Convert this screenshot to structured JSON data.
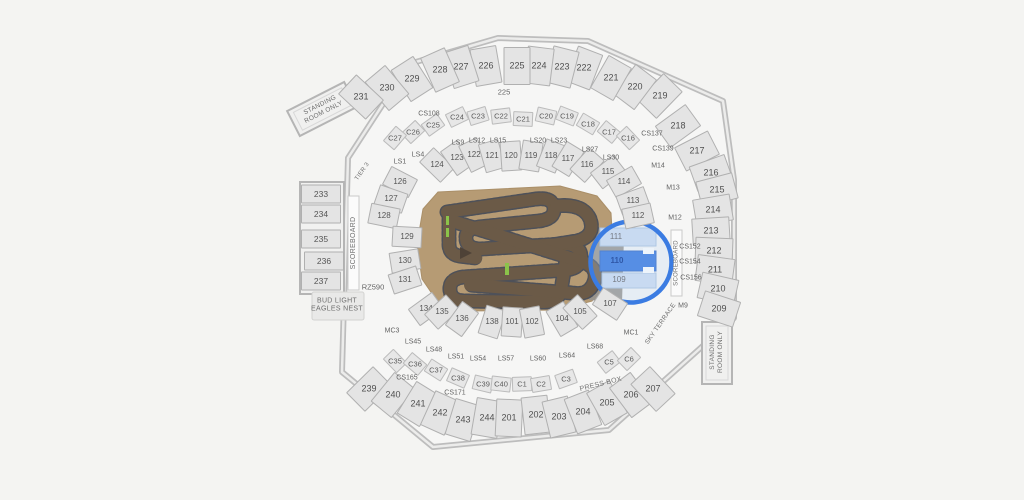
{
  "map": {
    "colors": {
      "background": "#f4f4f2",
      "section_fill": "#e4e4e4",
      "section_border": "#b0b0b0",
      "track_field": "#b69b74",
      "track_dirt": "#6b5a47",
      "track_edge": "#3d4555",
      "highlight_ring": "#3b7ce2",
      "selected_fill": "#2e72e0",
      "circled_fill": "#ccdcf1"
    },
    "highlight": {
      "selected_section": "110",
      "circled_sections": [
        "111",
        "110",
        "109"
      ]
    },
    "sections": [
      {
        "label": "219",
        "x": 660,
        "y": 96,
        "g": "upper"
      },
      {
        "label": "220",
        "x": 635,
        "y": 87,
        "g": "upper"
      },
      {
        "label": "221",
        "x": 611,
        "y": 78,
        "g": "upper"
      },
      {
        "label": "222",
        "x": 584,
        "y": 68,
        "g": "upper"
      },
      {
        "label": "223",
        "x": 562,
        "y": 67,
        "g": "upper"
      },
      {
        "label": "224",
        "x": 539,
        "y": 66,
        "g": "upper"
      },
      {
        "label": "225",
        "x": 517,
        "y": 66,
        "g": "upper"
      },
      {
        "label": "226",
        "x": 486,
        "y": 66,
        "g": "upper"
      },
      {
        "label": "227",
        "x": 461,
        "y": 67,
        "g": "upper"
      },
      {
        "label": "228",
        "x": 440,
        "y": 70,
        "g": "upper"
      },
      {
        "label": "229",
        "x": 412,
        "y": 79,
        "g": "upper"
      },
      {
        "label": "230",
        "x": 387,
        "y": 88,
        "g": "upper"
      },
      {
        "label": "231",
        "x": 361,
        "y": 97,
        "g": "upper"
      },
      {
        "label": "218",
        "x": 678,
        "y": 126,
        "g": "upper"
      },
      {
        "label": "217",
        "x": 697,
        "y": 151,
        "g": "upper"
      },
      {
        "label": "216",
        "x": 711,
        "y": 173,
        "g": "upper"
      },
      {
        "label": "215",
        "x": 717,
        "y": 190,
        "g": "upper"
      },
      {
        "label": "214",
        "x": 713,
        "y": 210,
        "g": "upper"
      },
      {
        "label": "213",
        "x": 711,
        "y": 231,
        "g": "upper"
      },
      {
        "label": "212",
        "x": 714,
        "y": 251,
        "g": "upper"
      },
      {
        "label": "211",
        "x": 715,
        "y": 270,
        "g": "upper"
      },
      {
        "label": "210",
        "x": 718,
        "y": 289,
        "g": "upper"
      },
      {
        "label": "209",
        "x": 719,
        "y": 309,
        "g": "upper"
      },
      {
        "label": "239",
        "x": 369,
        "y": 389,
        "g": "upper"
      },
      {
        "label": "240",
        "x": 393,
        "y": 395,
        "g": "upper"
      },
      {
        "label": "241",
        "x": 418,
        "y": 404,
        "g": "upper"
      },
      {
        "label": "242",
        "x": 440,
        "y": 413,
        "g": "upper"
      },
      {
        "label": "243",
        "x": 463,
        "y": 420,
        "g": "upper"
      },
      {
        "label": "244",
        "x": 487,
        "y": 418,
        "g": "upper"
      },
      {
        "label": "201",
        "x": 509,
        "y": 418,
        "g": "upper"
      },
      {
        "label": "202",
        "x": 536,
        "y": 415,
        "g": "upper"
      },
      {
        "label": "203",
        "x": 559,
        "y": 417,
        "g": "upper"
      },
      {
        "label": "204",
        "x": 583,
        "y": 412,
        "g": "upper"
      },
      {
        "label": "205",
        "x": 607,
        "y": 403,
        "g": "upper"
      },
      {
        "label": "206",
        "x": 631,
        "y": 395,
        "g": "upper"
      },
      {
        "label": "207",
        "x": 653,
        "y": 389,
        "g": "upper"
      },
      {
        "label": "233",
        "x": 321,
        "y": 194,
        "g": "side",
        "rot": 0
      },
      {
        "label": "234",
        "x": 321,
        "y": 214,
        "g": "side",
        "rot": 0
      },
      {
        "label": "235",
        "x": 321,
        "y": 239,
        "g": "side",
        "rot": 0
      },
      {
        "label": "236",
        "x": 324,
        "y": 261,
        "g": "side",
        "rot": 0
      },
      {
        "label": "237",
        "x": 321,
        "y": 281,
        "g": "side",
        "rot": 0
      },
      {
        "label": "124",
        "x": 437,
        "y": 165,
        "g": "lower"
      },
      {
        "label": "123",
        "x": 457,
        "y": 158,
        "g": "lower"
      },
      {
        "label": "122",
        "x": 474,
        "y": 155,
        "g": "lower"
      },
      {
        "label": "121",
        "x": 492,
        "y": 156,
        "g": "lower"
      },
      {
        "label": "120",
        "x": 511,
        "y": 156,
        "g": "lower"
      },
      {
        "label": "119",
        "x": 531,
        "y": 156,
        "g": "lower"
      },
      {
        "label": "118",
        "x": 551,
        "y": 156,
        "g": "lower"
      },
      {
        "label": "117",
        "x": 568,
        "y": 159,
        "g": "lower"
      },
      {
        "label": "116",
        "x": 587,
        "y": 165,
        "g": "lower"
      },
      {
        "label": "115",
        "x": 608,
        "y": 172,
        "g": "lower"
      },
      {
        "label": "114",
        "x": 624,
        "y": 182,
        "g": "lower"
      },
      {
        "label": "113",
        "x": 633,
        "y": 201,
        "g": "lower"
      },
      {
        "label": "112",
        "x": 638,
        "y": 216,
        "g": "lower"
      },
      {
        "label": "126",
        "x": 400,
        "y": 182,
        "g": "lower"
      },
      {
        "label": "127",
        "x": 391,
        "y": 199,
        "g": "lower"
      },
      {
        "label": "128",
        "x": 384,
        "y": 216,
        "g": "lower"
      },
      {
        "label": "129",
        "x": 407,
        "y": 237,
        "g": "lower"
      },
      {
        "label": "130",
        "x": 405,
        "y": 261,
        "g": "lower"
      },
      {
        "label": "131",
        "x": 405,
        "y": 280,
        "g": "lower"
      },
      {
        "label": "134",
        "x": 426,
        "y": 309,
        "g": "lower"
      },
      {
        "label": "135",
        "x": 442,
        "y": 312,
        "g": "lower"
      },
      {
        "label": "136",
        "x": 462,
        "y": 319,
        "g": "lower"
      },
      {
        "label": "138",
        "x": 492,
        "y": 322,
        "g": "lower"
      },
      {
        "label": "101",
        "x": 512,
        "y": 322,
        "g": "lower"
      },
      {
        "label": "102",
        "x": 532,
        "y": 322,
        "g": "lower"
      },
      {
        "label": "104",
        "x": 562,
        "y": 319,
        "g": "lower"
      },
      {
        "label": "105",
        "x": 580,
        "y": 312,
        "g": "lower"
      },
      {
        "label": "107",
        "x": 610,
        "y": 304,
        "g": "lower"
      },
      {
        "label": "111",
        "x": 616,
        "y": 237,
        "g": "endlabel"
      },
      {
        "label": "110",
        "x": 617,
        "y": 261,
        "g": "endlabel",
        "cls": "sel"
      },
      {
        "label": "109",
        "x": 619,
        "y": 280,
        "g": "endlabel"
      },
      {
        "label": "C24",
        "x": 457,
        "y": 117,
        "g": "club"
      },
      {
        "label": "C23",
        "x": 478,
        "y": 116,
        "g": "club"
      },
      {
        "label": "C22",
        "x": 501,
        "y": 116,
        "g": "club"
      },
      {
        "label": "C21",
        "x": 523,
        "y": 119,
        "g": "club"
      },
      {
        "label": "C20",
        "x": 546,
        "y": 116,
        "g": "club"
      },
      {
        "label": "C19",
        "x": 567,
        "y": 116,
        "g": "club"
      },
      {
        "label": "C18",
        "x": 588,
        "y": 124,
        "g": "club"
      },
      {
        "label": "C17",
        "x": 609,
        "y": 132,
        "g": "club"
      },
      {
        "label": "C16",
        "x": 628,
        "y": 138,
        "g": "club"
      },
      {
        "label": "C25",
        "x": 433,
        "y": 125,
        "g": "club"
      },
      {
        "label": "C26",
        "x": 413,
        "y": 132,
        "g": "club"
      },
      {
        "label": "C27",
        "x": 395,
        "y": 138,
        "g": "club"
      },
      {
        "label": "C35",
        "x": 395,
        "y": 361,
        "g": "club"
      },
      {
        "label": "C36",
        "x": 415,
        "y": 364,
        "g": "club"
      },
      {
        "label": "C37",
        "x": 436,
        "y": 370,
        "g": "club"
      },
      {
        "label": "C38",
        "x": 458,
        "y": 378,
        "g": "club"
      },
      {
        "label": "C39",
        "x": 483,
        "y": 384,
        "g": "club"
      },
      {
        "label": "C40",
        "x": 501,
        "y": 384,
        "g": "club"
      },
      {
        "label": "C1",
        "x": 522,
        "y": 384,
        "g": "club"
      },
      {
        "label": "C2",
        "x": 541,
        "y": 384,
        "g": "club"
      },
      {
        "label": "C3",
        "x": 566,
        "y": 379,
        "g": "club"
      },
      {
        "label": "C5",
        "x": 609,
        "y": 362,
        "g": "club"
      },
      {
        "label": "C6",
        "x": 629,
        "y": 359,
        "g": "club"
      },
      {
        "label": "CS108",
        "x": 429,
        "y": 114,
        "g": "strip"
      },
      {
        "label": "CS137",
        "x": 652,
        "y": 134,
        "g": "strip"
      },
      {
        "label": "CS139",
        "x": 663,
        "y": 149,
        "g": "strip"
      },
      {
        "label": "M14",
        "x": 658,
        "y": 166,
        "g": "strip"
      },
      {
        "label": "M13",
        "x": 673,
        "y": 188,
        "g": "strip"
      },
      {
        "label": "M12",
        "x": 675,
        "y": 218,
        "g": "strip"
      },
      {
        "label": "CS152",
        "x": 690,
        "y": 247,
        "g": "strip"
      },
      {
        "label": "CS154",
        "x": 690,
        "y": 262,
        "g": "strip"
      },
      {
        "label": "CS156",
        "x": 691,
        "y": 278,
        "g": "strip"
      },
      {
        "label": "M9",
        "x": 683,
        "y": 306,
        "g": "strip"
      },
      {
        "label": "MC1",
        "x": 631,
        "y": 333,
        "g": "strip"
      },
      {
        "label": "MC3",
        "x": 392,
        "y": 331,
        "g": "strip"
      },
      {
        "label": "CS165",
        "x": 407,
        "y": 378,
        "g": "strip"
      },
      {
        "label": "CS171",
        "x": 455,
        "y": 393,
        "g": "strip"
      },
      {
        "label": "LS1",
        "x": 400,
        "y": 162,
        "g": "strip"
      },
      {
        "label": "LS4",
        "x": 418,
        "y": 155,
        "g": "strip"
      },
      {
        "label": "LS9",
        "x": 458,
        "y": 143,
        "g": "strip"
      },
      {
        "label": "LS12",
        "x": 477,
        "y": 141,
        "g": "strip"
      },
      {
        "label": "LS15",
        "x": 498,
        "y": 141,
        "g": "strip"
      },
      {
        "label": "LS20",
        "x": 538,
        "y": 141,
        "g": "strip"
      },
      {
        "label": "LS23",
        "x": 559,
        "y": 141,
        "g": "strip"
      },
      {
        "label": "LS27",
        "x": 590,
        "y": 150,
        "g": "strip"
      },
      {
        "label": "LS30",
        "x": 611,
        "y": 158,
        "g": "strip"
      },
      {
        "label": "LS45",
        "x": 413,
        "y": 342,
        "g": "strip"
      },
      {
        "label": "LS48",
        "x": 434,
        "y": 350,
        "g": "strip"
      },
      {
        "label": "LS51",
        "x": 456,
        "y": 357,
        "g": "strip"
      },
      {
        "label": "LS54",
        "x": 478,
        "y": 359,
        "g": "strip"
      },
      {
        "label": "LS57",
        "x": 506,
        "y": 359,
        "g": "strip"
      },
      {
        "label": "LS60",
        "x": 538,
        "y": 359,
        "g": "strip"
      },
      {
        "label": "LS64",
        "x": 567,
        "y": 356,
        "g": "strip"
      },
      {
        "label": "LS68",
        "x": 595,
        "y": 347,
        "g": "strip"
      },
      {
        "label": "RZ590",
        "x": 373,
        "y": 287,
        "g": "txt"
      },
      {
        "label": "225",
        "x": 504,
        "y": 92,
        "g": "txt"
      }
    ],
    "annotations": [
      {
        "id": "standing-room-left",
        "text": "STANDING\nROOM ONLY",
        "x": 322,
        "y": 109,
        "rot": -27,
        "fs": 6.5
      },
      {
        "id": "standing-room-right",
        "text": "STANDING\nROOM ONLY",
        "x": 717,
        "y": 352,
        "rot": -90,
        "fs": 6.5
      },
      {
        "id": "scoreboard-left",
        "text": "SCOREBOARD",
        "x": 354,
        "y": 243,
        "rot": -90,
        "fs": 7
      },
      {
        "id": "scoreboard-right",
        "text": "SCOREBOARD",
        "x": 677,
        "y": 263,
        "rot": -90,
        "fs": 6
      },
      {
        "id": "eagles-nest",
        "text": "BUD LIGHT\nEAGLES NEST",
        "x": 337,
        "y": 306,
        "rot": 0,
        "fs": 7
      },
      {
        "id": "sky-terrace",
        "text": "SKY TERRACE",
        "x": 661,
        "y": 324,
        "rot": -55,
        "fs": 6.5
      },
      {
        "id": "press-box",
        "text": "PRESS BOX",
        "x": 601,
        "y": 385,
        "rot": -14,
        "fs": 7
      },
      {
        "id": "tier-3",
        "text": "TIER 3",
        "x": 363,
        "y": 172,
        "rot": -55,
        "fs": 6
      }
    ]
  }
}
